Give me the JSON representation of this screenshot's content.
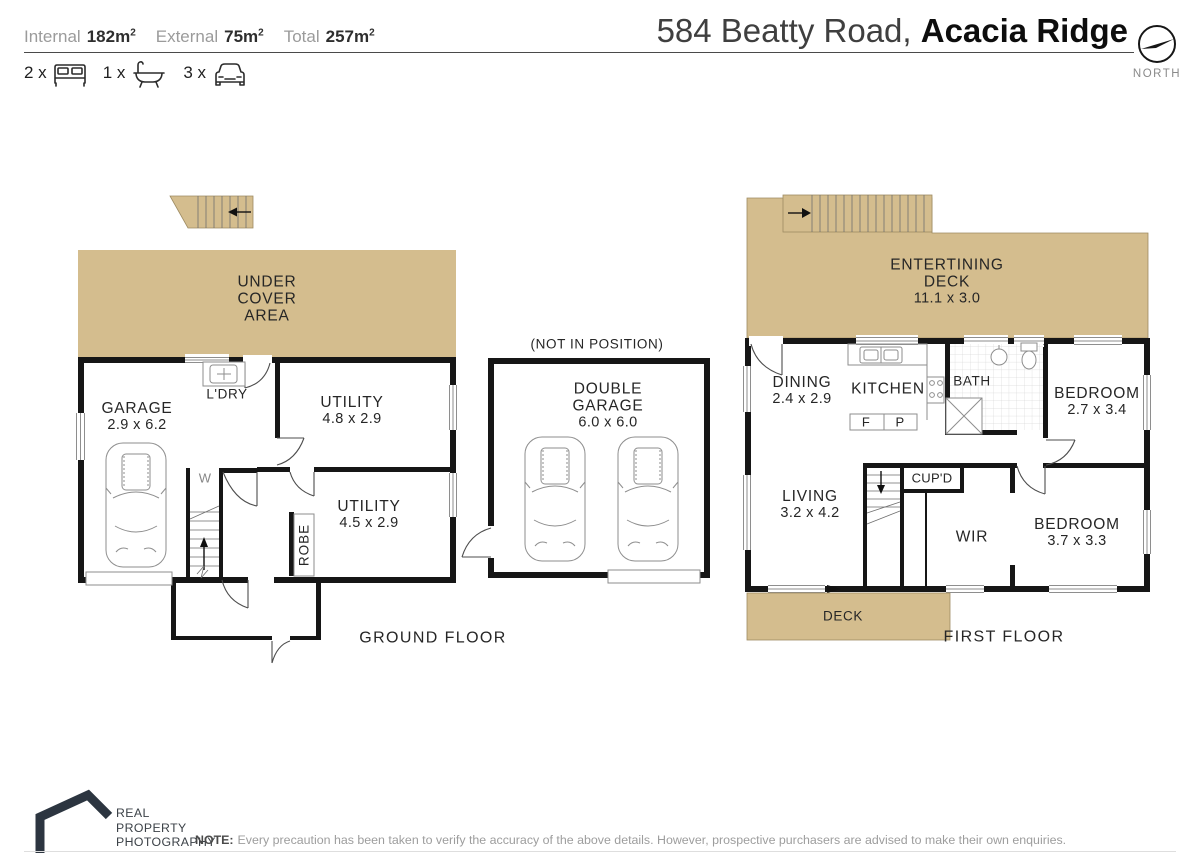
{
  "colors": {
    "tan": "#d4bd8e",
    "wall": "#161616",
    "line": "#8e8e8e",
    "logo": "#2c3540"
  },
  "header": {
    "stats": [
      {
        "label": "Internal",
        "value": "182m",
        "sup": "2"
      },
      {
        "label": "External",
        "value": "75m",
        "sup": "2"
      },
      {
        "label": "Total",
        "value": "257m",
        "sup": "2"
      }
    ],
    "counts": [
      {
        "qty": "2 x",
        "icon": "bed-icon"
      },
      {
        "qty": "1 x",
        "icon": "bath-icon"
      },
      {
        "qty": "3 x",
        "icon": "car-icon"
      }
    ],
    "title": {
      "light": "584 Beatty Road, ",
      "bold": "Acacia Ridge"
    },
    "compass": "NORTH"
  },
  "ground_floor": {
    "label": "GROUND FLOOR",
    "under_cover": [
      "UNDER",
      "COVER",
      "AREA"
    ],
    "garage": {
      "name": "GARAGE",
      "dims": "2.9 x 6.2"
    },
    "laundry": {
      "name": "L'DRY"
    },
    "utility_top": {
      "name": "UTILITY",
      "dims": "4.8 x 2.9"
    },
    "utility_bottom": {
      "name": "UTILITY",
      "dims": "4.5 x 2.9"
    },
    "robe": {
      "name": "ROBE"
    },
    "stair_mark": "W"
  },
  "double_garage": {
    "note": "(NOT IN POSITION)",
    "name": [
      "DOUBLE",
      "GARAGE"
    ],
    "dims": "6.0 x 6.0"
  },
  "first_floor": {
    "label": "FIRST FLOOR",
    "deck_top": {
      "name": [
        "ENTERTINING",
        "DECK"
      ],
      "dims": "11.1 x 3.0"
    },
    "dining": {
      "name": "DINING",
      "dims": "2.4 x 2.9"
    },
    "kitchen": {
      "name": "KITCHEN",
      "fridge": "F",
      "pantry": "P"
    },
    "bath": {
      "name": "BATH"
    },
    "bedroom_top": {
      "name": "BEDROOM",
      "dims": "2.7 x 3.4"
    },
    "living": {
      "name": "LIVING",
      "dims": "3.2 x 4.2"
    },
    "cupboard": {
      "name": "CUP'D"
    },
    "wir": {
      "name": "WIR"
    },
    "bedroom_bottom": {
      "name": "BEDROOM",
      "dims": "3.7 x 3.3"
    },
    "deck_bottom": {
      "name": "DECK"
    }
  },
  "footer": {
    "logo": [
      "REAL",
      "PROPERTY",
      "PHOTOGRAPHY"
    ],
    "note_label": "NOTE:",
    "note_text": "Every precaution has been taken to verify the accuracy of the above details. However, prospective purchasers are advised to make their own enquiries."
  }
}
